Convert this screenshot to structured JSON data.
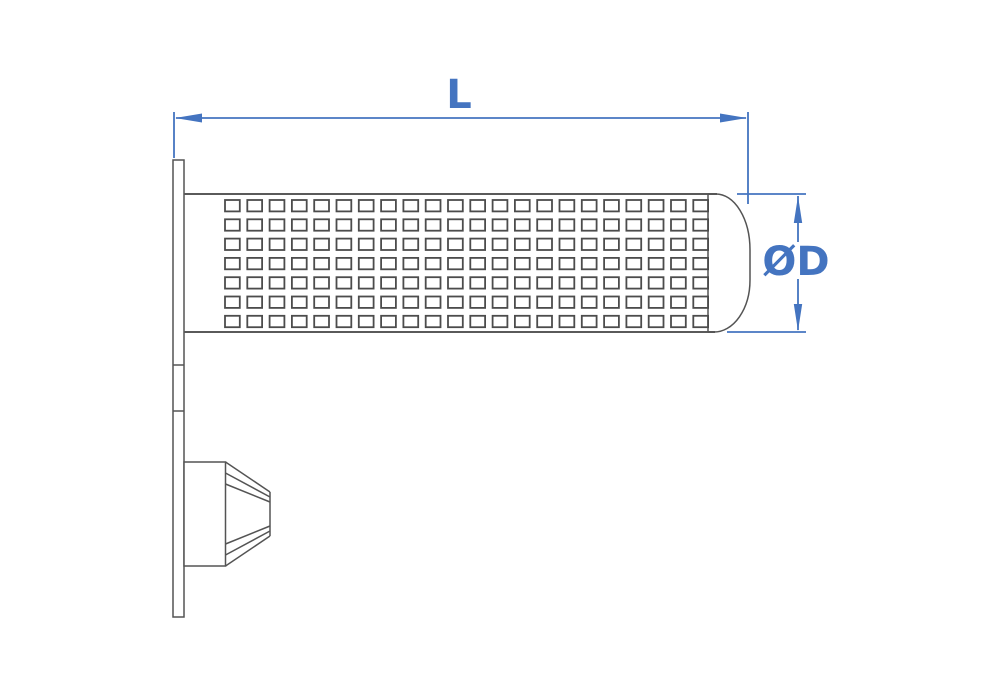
{
  "drawing": {
    "labels": {
      "length": "L",
      "diameter": "ØD"
    },
    "colors": {
      "dimension": "#4474c0",
      "outline": "#545454",
      "background": "#ffffff"
    },
    "mesh": {
      "rows": 7,
      "columns": 22
    }
  }
}
